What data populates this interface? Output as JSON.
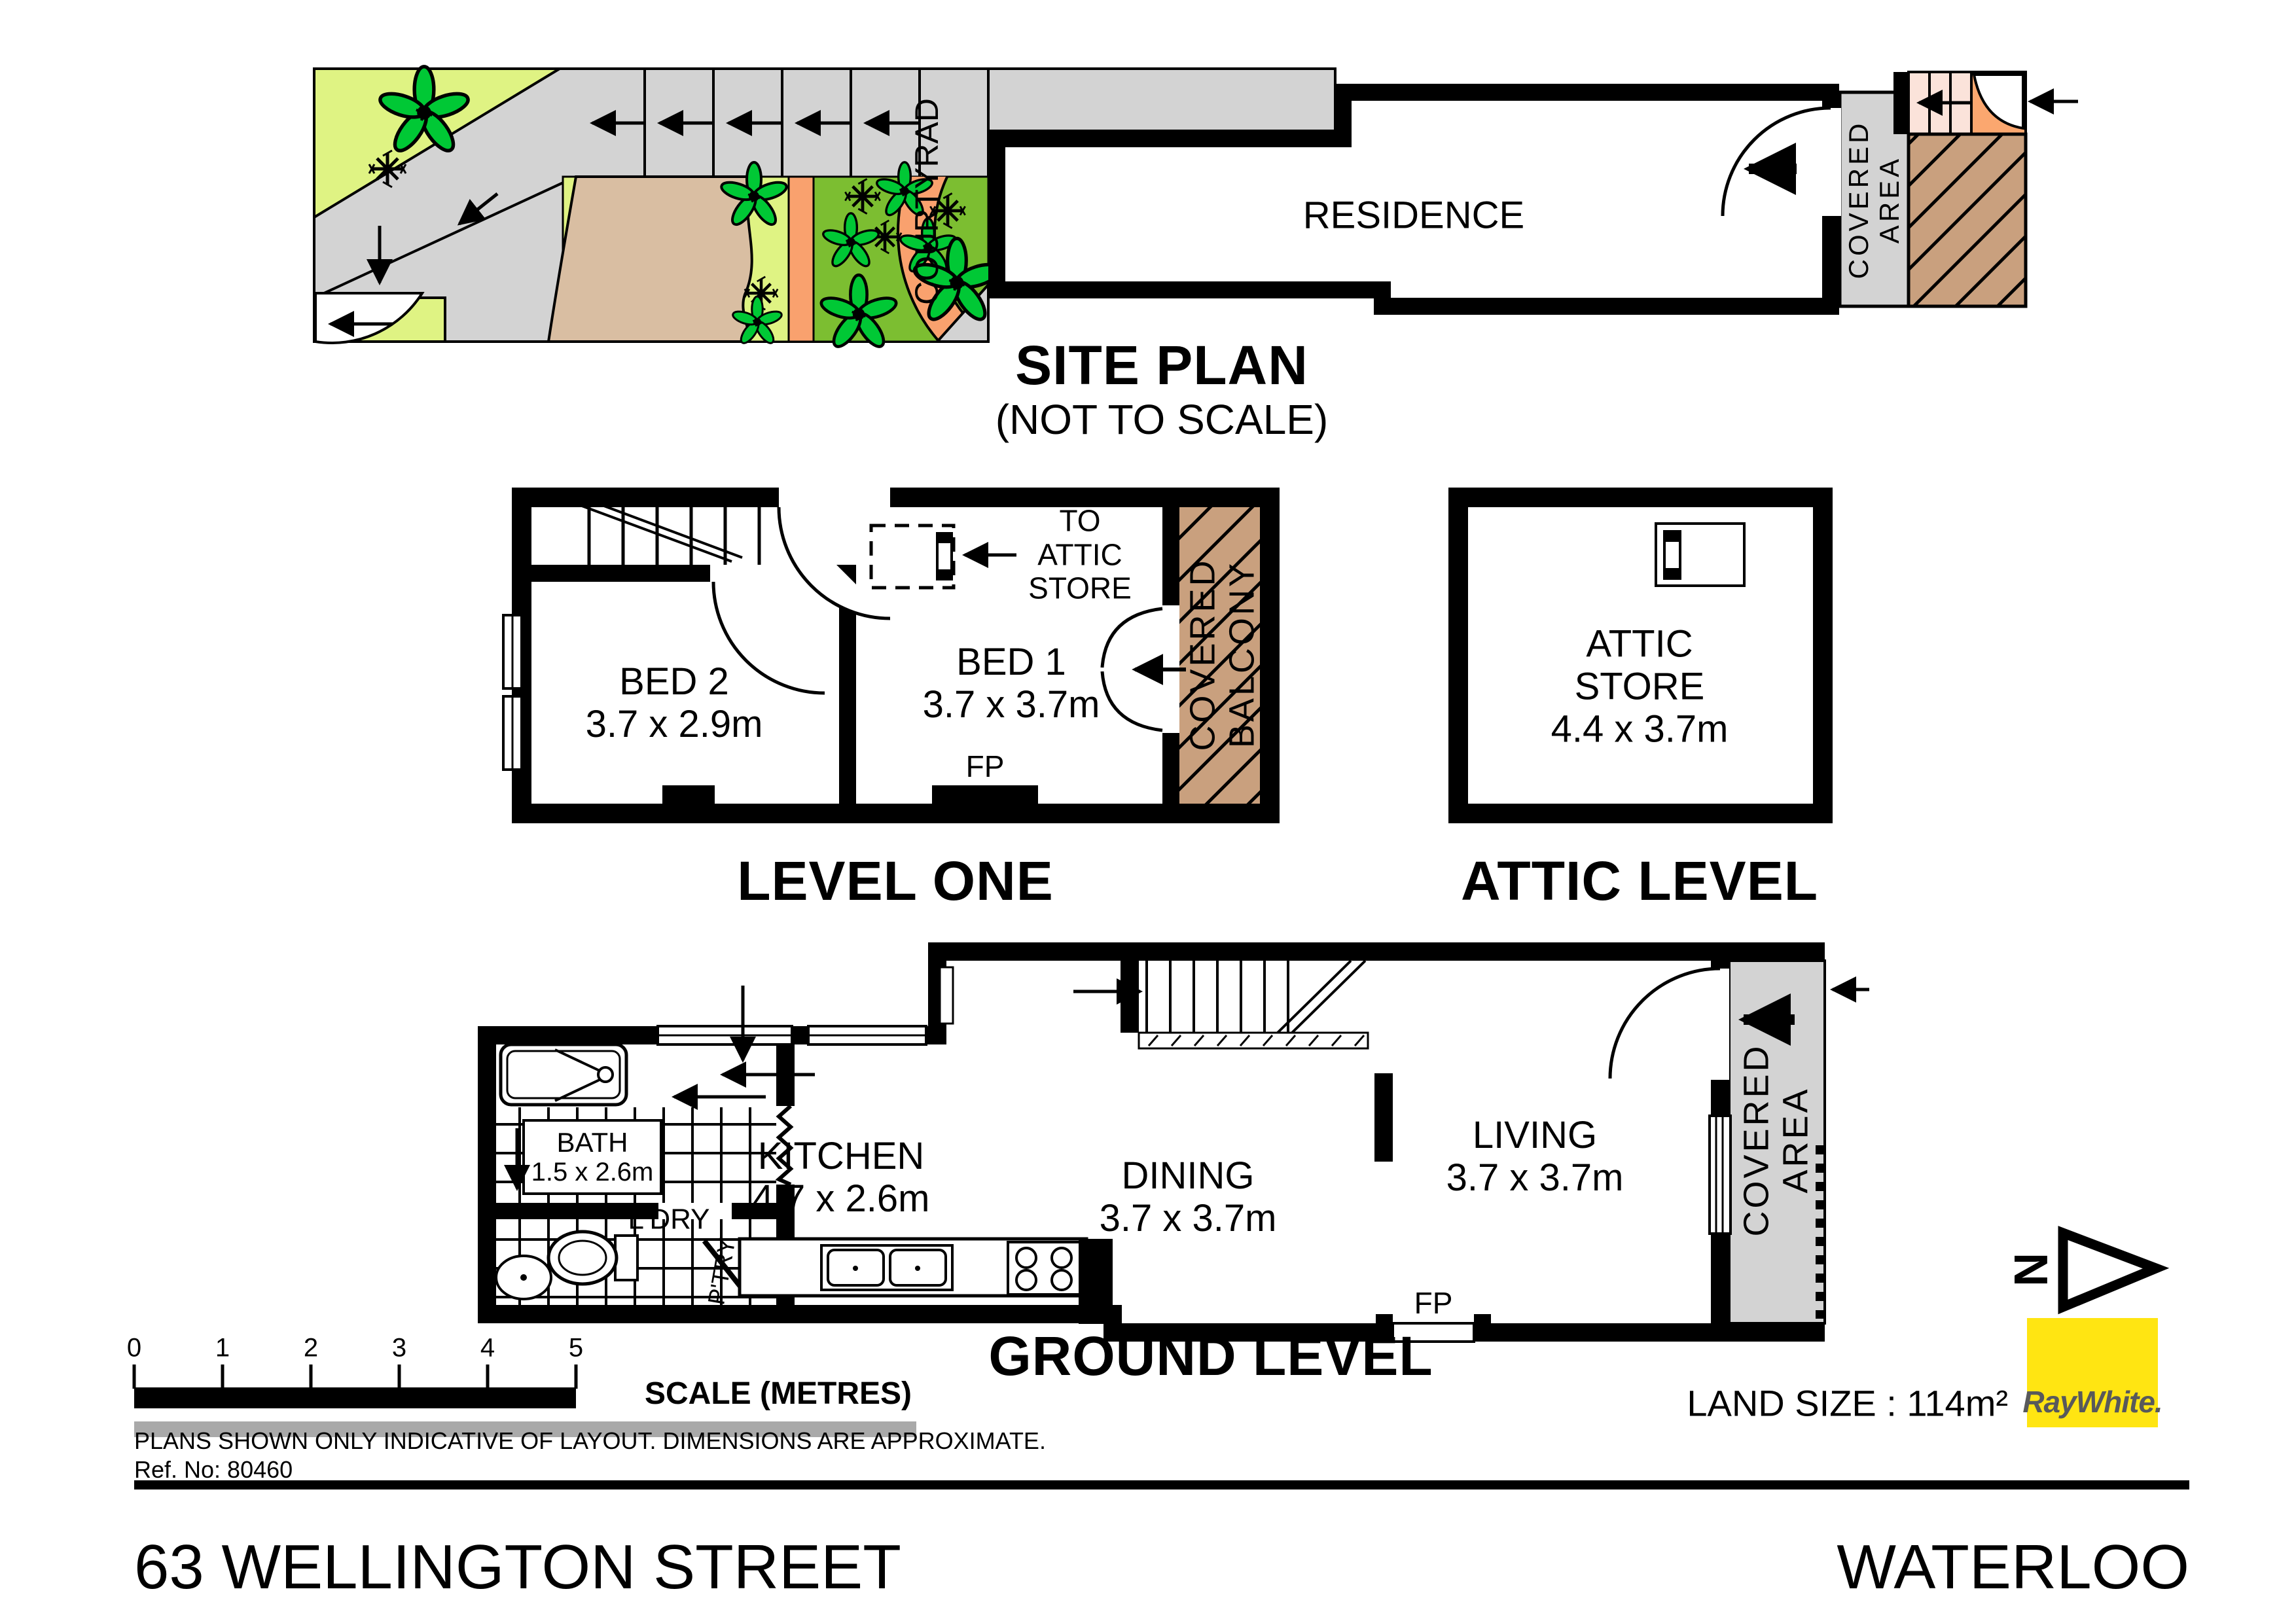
{
  "site_plan": {
    "title": "SITE PLAN",
    "subtitle": "(NOT TO SCALE)",
    "residence_label": "RESIDENCE",
    "courtyard_label": "COURTYRAD",
    "covered_area_line1": "COVERED",
    "covered_area_line2": "AREA"
  },
  "level_one": {
    "title": "LEVEL ONE",
    "bed2_name": "BED 2",
    "bed2_dim": "3.7 x 2.9m",
    "bed1_name": "BED 1",
    "bed1_dim": "3.7 x 3.7m",
    "attic_access_line1": "TO",
    "attic_access_line2": "ATTIC",
    "attic_access_line3": "STORE",
    "fireplace_label": "FP",
    "balcony_line1": "COVERED",
    "balcony_line2": "BALCONY"
  },
  "attic_level": {
    "title": "ATTIC LEVEL",
    "room_line1": "ATTIC",
    "room_line2": "STORE",
    "room_dim": "4.4 x 3.7m"
  },
  "ground_level": {
    "title": "GROUND LEVEL",
    "kitchen_name": "KITCHEN",
    "kitchen_dim": "4.7 x 2.6m",
    "dining_name": "DINING",
    "dining_dim": "3.7 x 3.7m",
    "living_name": "LIVING",
    "living_dim": "3.7 x 3.7m",
    "bath_name": "BATH",
    "bath_dim": "1.5 x 2.6m",
    "laundry_label": "L'DRY",
    "pantry_label": "P'TRY",
    "fireplace_label": "FP",
    "covered_line1": "COVERED",
    "covered_line2": "AREA"
  },
  "scale_bar": {
    "ticks": [
      "0",
      "1",
      "2",
      "3",
      "4",
      "5"
    ],
    "label": "SCALE (METRES)"
  },
  "disclaimer": {
    "line1": "PLANS SHOWN ONLY INDICATIVE OF LAYOUT.  DIMENSIONS ARE APPROXIMATE.",
    "line2": "Ref. No: 80460"
  },
  "footer": {
    "address": "63 WELLINGTON STREET",
    "suburb": "WATERLOO",
    "land_size": "LAND SIZE : 114m²",
    "north_label": "N"
  },
  "branding": {
    "name": "RayWhite.",
    "box_color": "#FFE512",
    "text_color": "#58595B"
  },
  "colors": {
    "garden_light_green": "#DFF383",
    "lawn_green": "#7CBE31",
    "path_gray": "#D3D3D3",
    "path_orange": "#F9A16E",
    "soil_tan": "#D9BEA2",
    "hatch_brown": "#C9A07E",
    "steps_pink": "#FBE3DA",
    "door_cell_orange": "#FBA76F",
    "wall_black": "#000000"
  }
}
